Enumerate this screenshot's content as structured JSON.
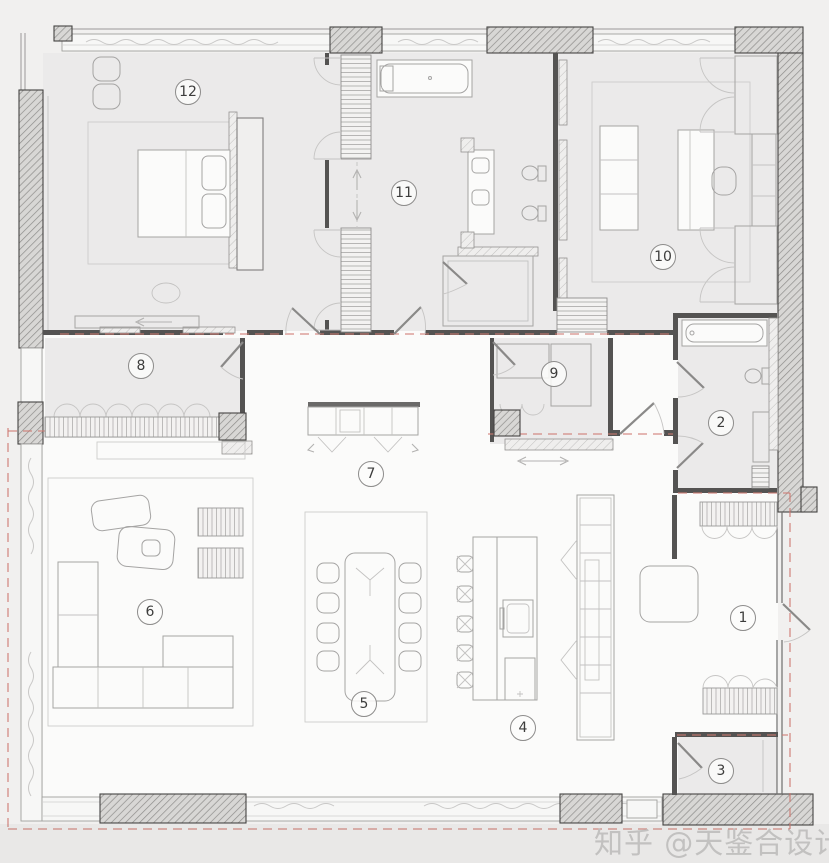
{
  "watermark": {
    "text": "知乎 @天鉴合设计"
  },
  "plan": {
    "type": "apartment-floor-plan",
    "room_labels": [
      {
        "number": "1",
        "x": 743,
        "y": 618
      },
      {
        "number": "2",
        "x": 721,
        "y": 423
      },
      {
        "number": "3",
        "x": 721,
        "y": 771
      },
      {
        "number": "4",
        "x": 523,
        "y": 728
      },
      {
        "number": "5",
        "x": 364,
        "y": 704
      },
      {
        "number": "6",
        "x": 150,
        "y": 612
      },
      {
        "number": "7",
        "x": 371,
        "y": 474
      },
      {
        "number": "8",
        "x": 141,
        "y": 366
      },
      {
        "number": "9",
        "x": 554,
        "y": 374
      },
      {
        "number": "10",
        "x": 663,
        "y": 257
      },
      {
        "number": "11",
        "x": 404,
        "y": 193
      },
      {
        "number": "12",
        "x": 188,
        "y": 92
      }
    ],
    "colors": {
      "background": "#f1f0ef",
      "room_fill": "#ebeaea",
      "open_area_fill": "#fbfbfa",
      "wall_dark": "#545352",
      "dashed_line": "#cf7a72",
      "furniture_line": "#a5a4a3",
      "label_text": "#3d3d3c",
      "watermark_text": "#c6c5c4"
    }
  }
}
